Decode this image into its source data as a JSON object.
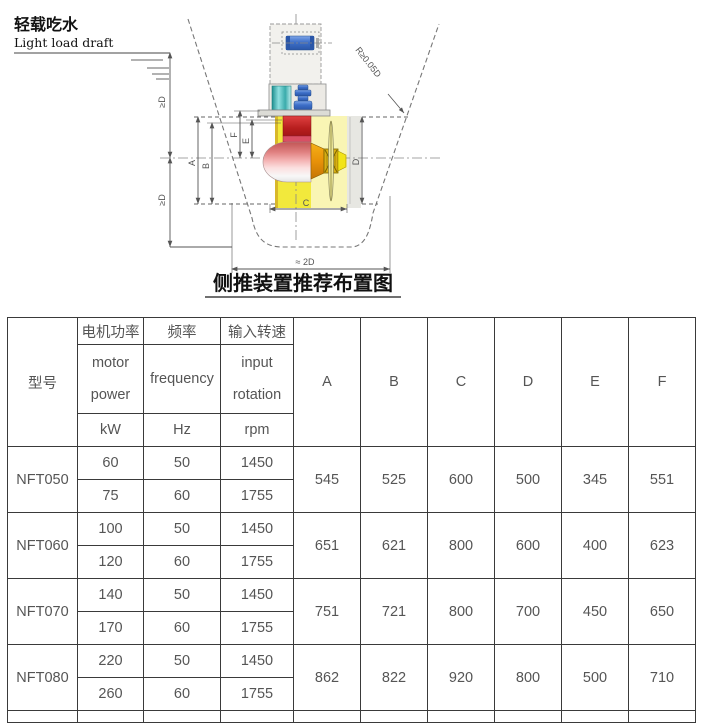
{
  "diagram": {
    "draft_label_zh": "轻载吃水",
    "draft_label_en": "Light load draft",
    "caption": "侧推装置推荐布置图",
    "labels": {
      "ge_d_upper": "≥D",
      "ge_d_lower": "≥D",
      "radius": "R≥0.05D",
      "bottom_width": "≈ 2D",
      "dim_a": "A",
      "dim_b": "B",
      "dim_c": "C",
      "dim_d": "D",
      "dim_e": "E",
      "dim_f": "F"
    }
  },
  "table": {
    "header": {
      "model": "型号",
      "power_zh": "电机功率",
      "power_en_1": "motor",
      "power_en_2": "power",
      "power_unit": "kW",
      "freq_zh": "频率",
      "freq_en": "frequency",
      "freq_unit": "Hz",
      "rot_zh": "输入转速",
      "rot_en_1": "input",
      "rot_en_2": "rotation",
      "rot_unit": "rpm",
      "dims": [
        "A",
        "B",
        "C",
        "D",
        "E",
        "F"
      ]
    },
    "rows": [
      {
        "model": "NFT050",
        "variants": [
          {
            "power": "60",
            "freq": "50",
            "rpm": "1450"
          },
          {
            "power": "75",
            "freq": "60",
            "rpm": "1755"
          }
        ],
        "dims": [
          "545",
          "525",
          "600",
          "500",
          "345",
          "551"
        ]
      },
      {
        "model": "NFT060",
        "variants": [
          {
            "power": "100",
            "freq": "50",
            "rpm": "1450"
          },
          {
            "power": "120",
            "freq": "60",
            "rpm": "1755"
          }
        ],
        "dims": [
          "651",
          "621",
          "800",
          "600",
          "400",
          "623"
        ]
      },
      {
        "model": "NFT070",
        "variants": [
          {
            "power": "140",
            "freq": "50",
            "rpm": "1450"
          },
          {
            "power": "170",
            "freq": "60",
            "rpm": "1755"
          }
        ],
        "dims": [
          "751",
          "721",
          "800",
          "700",
          "450",
          "650"
        ]
      },
      {
        "model": "NFT080",
        "variants": [
          {
            "power": "220",
            "freq": "50",
            "rpm": "1450"
          },
          {
            "power": "260",
            "freq": "60",
            "rpm": "1755"
          }
        ],
        "dims": [
          "862",
          "822",
          "920",
          "800",
          "500",
          "710"
        ]
      }
    ]
  },
  "colors": {
    "border": "#3a3a3a",
    "text": "#555555",
    "motor_blue": "#4a7fd0",
    "coupling_teal": "#3fae ae",
    "gearbox_red": "#c42a2a",
    "tunnel_yellow": "#f2e93c"
  }
}
